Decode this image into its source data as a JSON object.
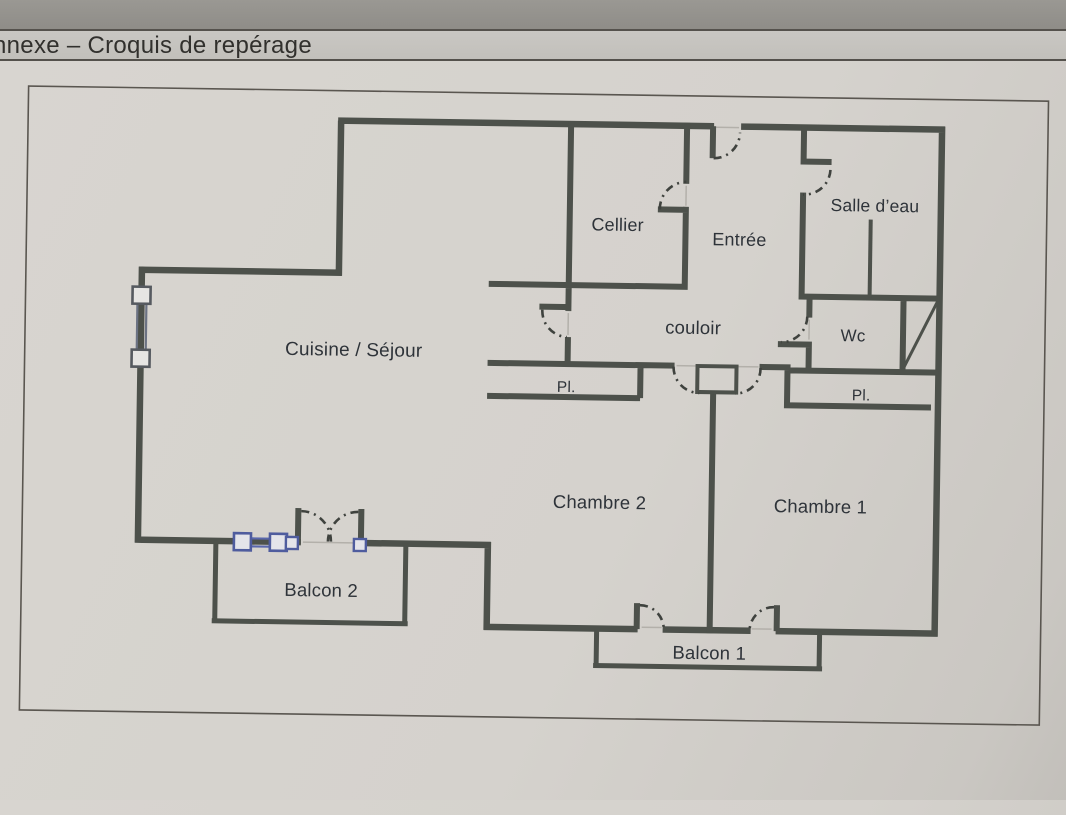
{
  "header": {
    "title": "nnexe – Croquis de repérage"
  },
  "plan": {
    "labels": {
      "cellier": "Cellier",
      "entree": "Entrée",
      "salle_deau": "Salle d’eau",
      "couloir": "couloir",
      "wc": "Wc",
      "cuisine_sejour": "Cuisine / Séjour",
      "placard_chambre2": "Pl.",
      "placard_chambre1": "Pl.",
      "chambre2": "Chambre 2",
      "chambre1": "Chambre 1",
      "balcon2": "Balcon 2",
      "balcon1": "Balcon 1"
    },
    "colors": {
      "wall": "#4d514b",
      "window_accent": "#4f5c9e",
      "paper": "#d6d3ce",
      "header_band": "#c6c4bf",
      "label_text": "#2e3339"
    }
  }
}
